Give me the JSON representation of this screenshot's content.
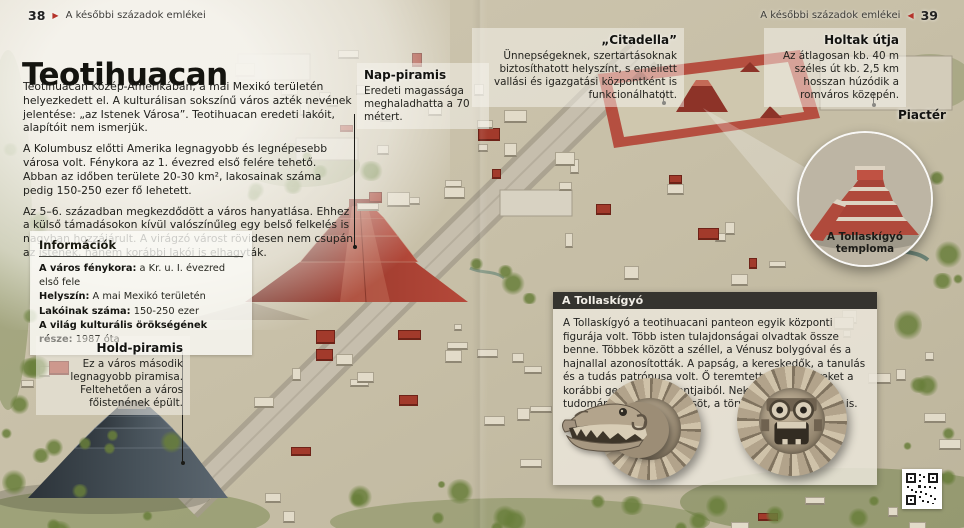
{
  "page": {
    "header_left": {
      "page_number": "38",
      "title": "A későbbi századok emlékei"
    },
    "header_right": {
      "page_number": "39",
      "title": "A későbbi századok emlékei"
    }
  },
  "icons": {
    "page_marker_right": "▶",
    "page_marker_left": "◀"
  },
  "article": {
    "title": "Teotihuacan",
    "paragraphs": [
      "Teotihuacan Közép-Amerikában, a mai Mexikó területén helyezkedett el. A kulturálisan sokszínű város azték nevének jelentése: „az Istenek Városa”. Teotihuacan eredeti lakóit, alapítóit nem ismerjük.",
      "A Kolumbusz előtti Amerika legnagyobb és legnépesebb városa volt. Fénykora az 1. évezred első felére tehető. Abban az időben területe 20-30 km², lakosainak száma pedig 150-250 ezer fő lehetett.",
      "Az 5–6. században megkezdődött a város hanyatlása. Ehhez a külső támadásokon kívül valószínűleg egy belső felkelés is nagyban hozzájárult. A virágzó várost rövidesen nem csupán az istenek, hanem korábbi lakói is elhagyták."
    ]
  },
  "info_box": {
    "title": "Információk",
    "rows": [
      {
        "label": "A város fénykora:",
        "value": "a Kr. u. I. évezred első fele"
      },
      {
        "label": "Helyszín:",
        "value": "A mai Mexikó területén"
      },
      {
        "label": "Lakóinak száma:",
        "value": "150-250 ezer"
      },
      {
        "label": "A világ kulturális örökségének része:",
        "value": "1987 óta"
      }
    ]
  },
  "callouts": {
    "moon_pyramid": {
      "title": "Hold-piramis",
      "text": "Ez a város második legnagyobb piramisa. Feltehetően a város főistenének épült."
    },
    "sun_pyramid": {
      "title": "Nap-piramis",
      "text": "Eredeti magassága meghaladhatta a 70 métert."
    },
    "citadel": {
      "title": "„Citadella”",
      "text": "Ünnepségeknek, szertartásoknak biztosíthatott helyszínt, s emellett vallási és igazgatási központként is funkcionálhatott."
    },
    "avenue_of_the_dead": {
      "title": "Holtak útja",
      "text": "Az átlagosan kb. 40 m széles út kb. 2,5 km hosszan húzódik a romváros közepén."
    },
    "marketplace_label": "Piactér"
  },
  "inset": {
    "caption": "A Tollaskígyó temploma"
  },
  "feathered_serpent_box": {
    "title": "A Tollaskígyó",
    "text": "A Tollaskígyó a teotihuacani panteon egyik központi figurája volt. Több isten tulajdonságai olvadtak össze benne. Többek között a széllel, a Vénusz bolygóval és a hajnallal azonosították. A papság, a kereskedők, a tanulás és a tudás patrónusa volt. Ő teremtette az embereket a korábbi generációk csontjaiból. Neki köszönhették a tudományokat, az erkölcsöt, a törvényeket és az írást is."
  },
  "colors": {
    "accent_red": "#b5332a",
    "panel_header_dark": "#2a2926",
    "pyramid_red": "#9d3a2d",
    "pyramid_slate": "#47525a",
    "ground_tan": "#c9c1aa"
  }
}
